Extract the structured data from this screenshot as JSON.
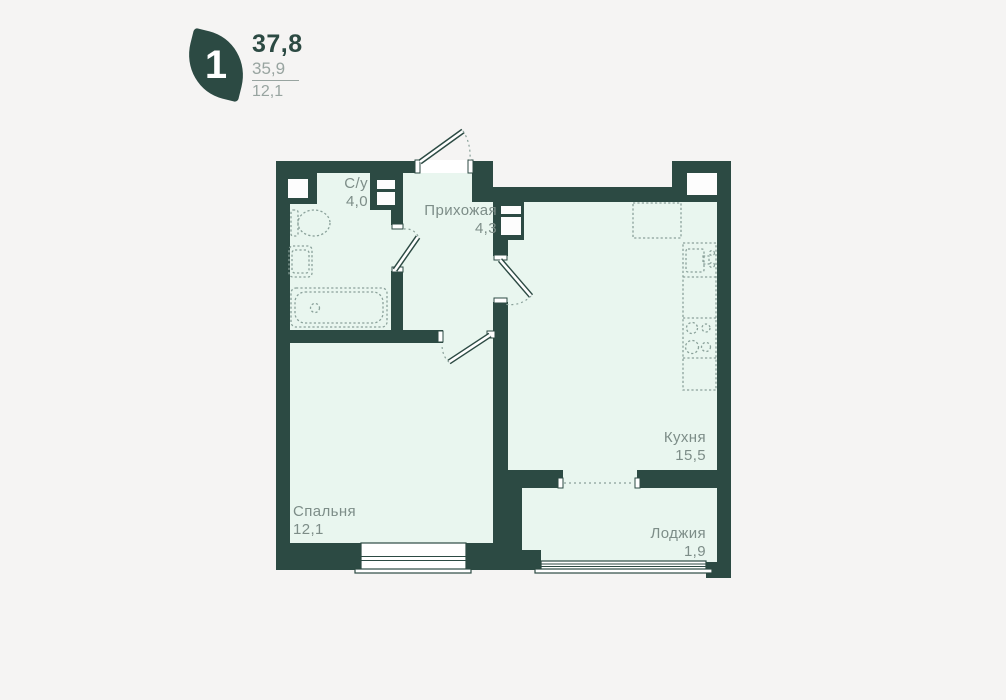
{
  "badge": {
    "rooms_count": "1",
    "area_main": "37,8",
    "area_secondary": "35,9",
    "area_tertiary": "12,1"
  },
  "plan": {
    "rooms": [
      {
        "name": "С/у",
        "area": "4,0"
      },
      {
        "name": "Прихожая",
        "area": "4,3"
      },
      {
        "name": "Кухня",
        "area": "15,5"
      },
      {
        "name": "Спальня",
        "area": "12,1"
      },
      {
        "name": "Лоджия",
        "area": "1,9"
      }
    ]
  },
  "colors": {
    "wall": "#2c4a43",
    "floor": "#e9f6ef",
    "background": "#f5f4f3",
    "label": "#7d8d88",
    "fixture": "#8aa19a",
    "badge-secondary": "#98a4a0",
    "niche": "#fdfdfd"
  }
}
